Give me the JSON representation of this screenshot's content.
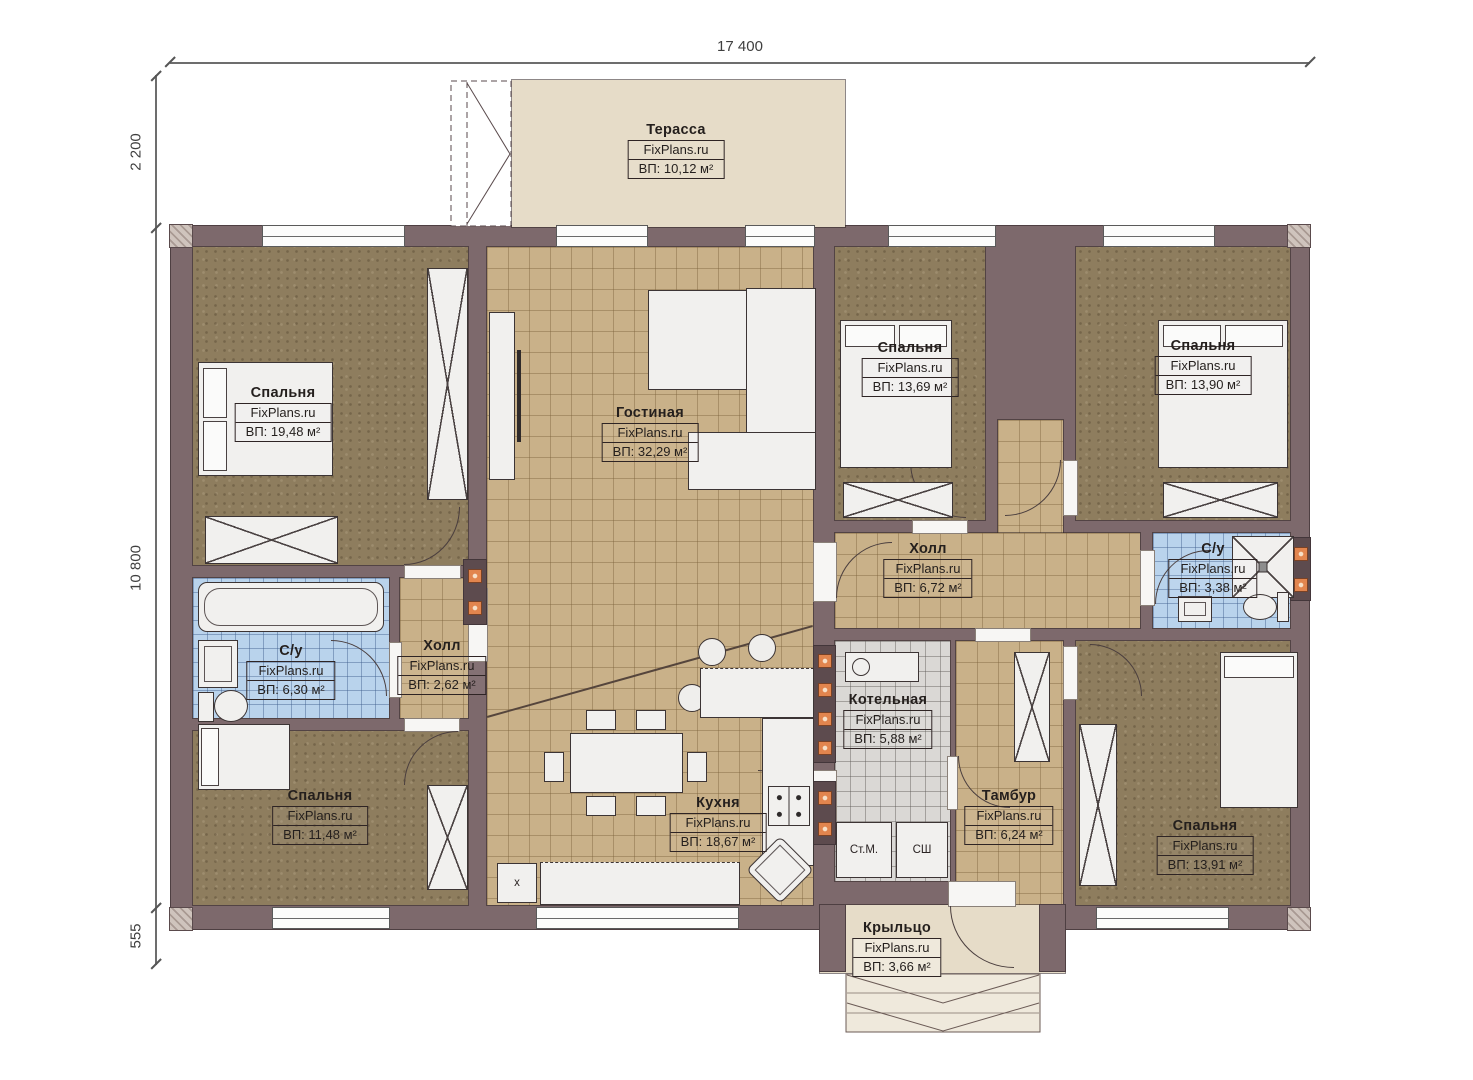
{
  "site_watermark": "FixPlans.ru",
  "dimensions": {
    "top": "17 400",
    "left_upper": "2 200",
    "left_main": "10 800",
    "left_lower": "555"
  },
  "rooms": [
    {
      "id": "terrace",
      "name": "Терасса",
      "watermark": "FixPlans.ru",
      "area": "ВП: 10,12 м²"
    },
    {
      "id": "bedroom_tl",
      "name": "Спальня",
      "watermark": "FixPlans.ru",
      "area": "ВП: 19,48 м²"
    },
    {
      "id": "living_room",
      "name": "Гостиная",
      "watermark": "FixPlans.ru",
      "area": "ВП: 32,29 м²"
    },
    {
      "id": "bedroom_center",
      "name": "Спальня",
      "watermark": "FixPlans.ru",
      "area": "ВП: 13,69 м²"
    },
    {
      "id": "bedroom_tr",
      "name": "Спальня",
      "watermark": "FixPlans.ru",
      "area": "ВП: 13,90 м²"
    },
    {
      "id": "hall_main",
      "name": "Холл",
      "watermark": "FixPlans.ru",
      "area": "ВП: 6,72 м²"
    },
    {
      "id": "bathroom_small",
      "name": "С/у",
      "watermark": "FixPlans.ru",
      "area": "ВП: 3,38 м²"
    },
    {
      "id": "bathroom_left",
      "name": "С/у",
      "watermark": "FixPlans.ru",
      "area": "ВП: 6,30 м²"
    },
    {
      "id": "hall_small",
      "name": "Холл",
      "watermark": "FixPlans.ru",
      "area": "ВП: 2,62 м²"
    },
    {
      "id": "boiler_room",
      "name": "Котельная",
      "watermark": "FixPlans.ru",
      "area": "ВП: 5,88 м²"
    },
    {
      "id": "bedroom_bl",
      "name": "Спальня",
      "watermark": "FixPlans.ru",
      "area": "ВП: 11,48 м²"
    },
    {
      "id": "kitchen",
      "name": "Кухня",
      "watermark": "FixPlans.ru",
      "area": "ВП: 18,67 м²"
    },
    {
      "id": "tambour",
      "name": "Тамбур",
      "watermark": "FixPlans.ru",
      "area": "ВП: 6,24 м²"
    },
    {
      "id": "bedroom_br",
      "name": "Спальня",
      "watermark": "FixPlans.ru",
      "area": "ВП: 13,91 м²"
    },
    {
      "id": "porch",
      "name": "Крыльцо",
      "watermark": "FixPlans.ru",
      "area": "ВП: 3,66 м²"
    }
  ],
  "appliances": {
    "washing_machine": "Ст.М.",
    "drying_cabinet": "СШ",
    "fridge_mark": "x"
  },
  "colors": {
    "wall": "#7d696c",
    "tile_floor": "#c9b189",
    "bedroom_floor": "#8e7d5e",
    "bathroom_tile": "#b9d3ec",
    "boiler_tile": "#dad8d5",
    "terrace_floor": "#e6dcc8",
    "marker_orange": "#e2854e"
  }
}
